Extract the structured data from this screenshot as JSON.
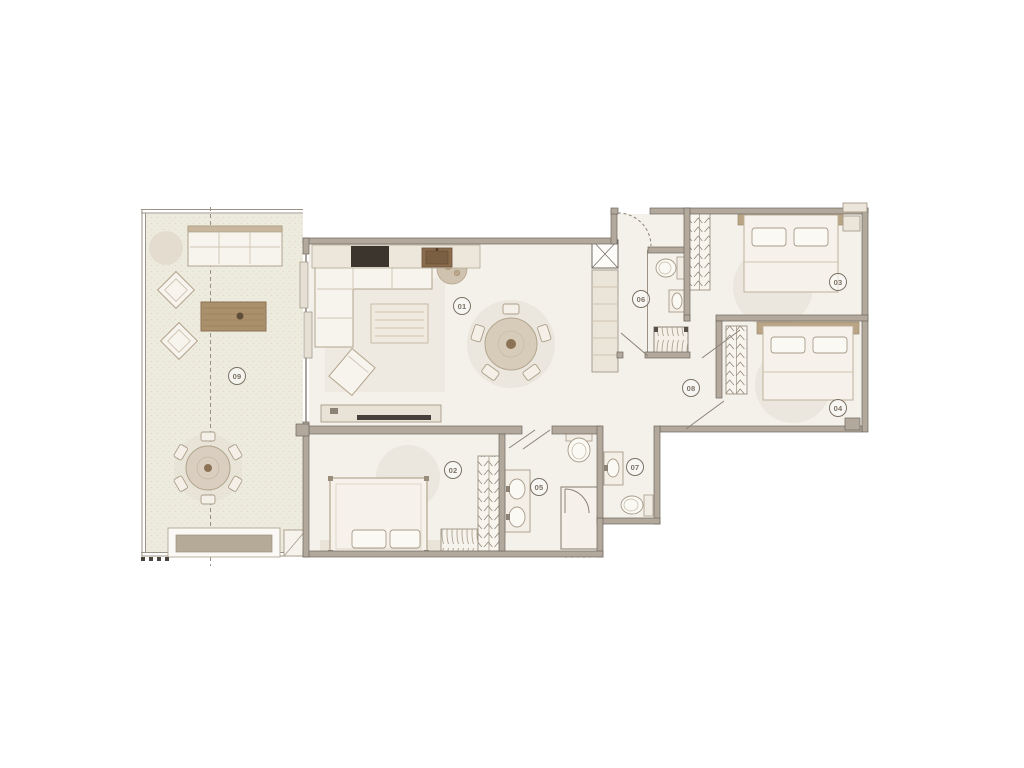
{
  "floor_plan": {
    "room_labels": [
      "01",
      "02",
      "03",
      "04",
      "05",
      "06",
      "07",
      "08",
      "09"
    ],
    "palette": {
      "background": "#ffffff",
      "wall": "#b2a99c",
      "wall_line": "#6e675e",
      "floor": "#f4f1ea",
      "terrace_floor": "#edeade",
      "furniture_fill": "#f7f4ee",
      "furniture_line": "#b2a38c",
      "wood_table": "#ab906c",
      "headboard": "#b9a586",
      "cooktop": "#3b352e",
      "kitchen_sink": "#8a6c4c",
      "label_ring": "#7b7266",
      "shadow_blob": "#e5ded3"
    }
  }
}
